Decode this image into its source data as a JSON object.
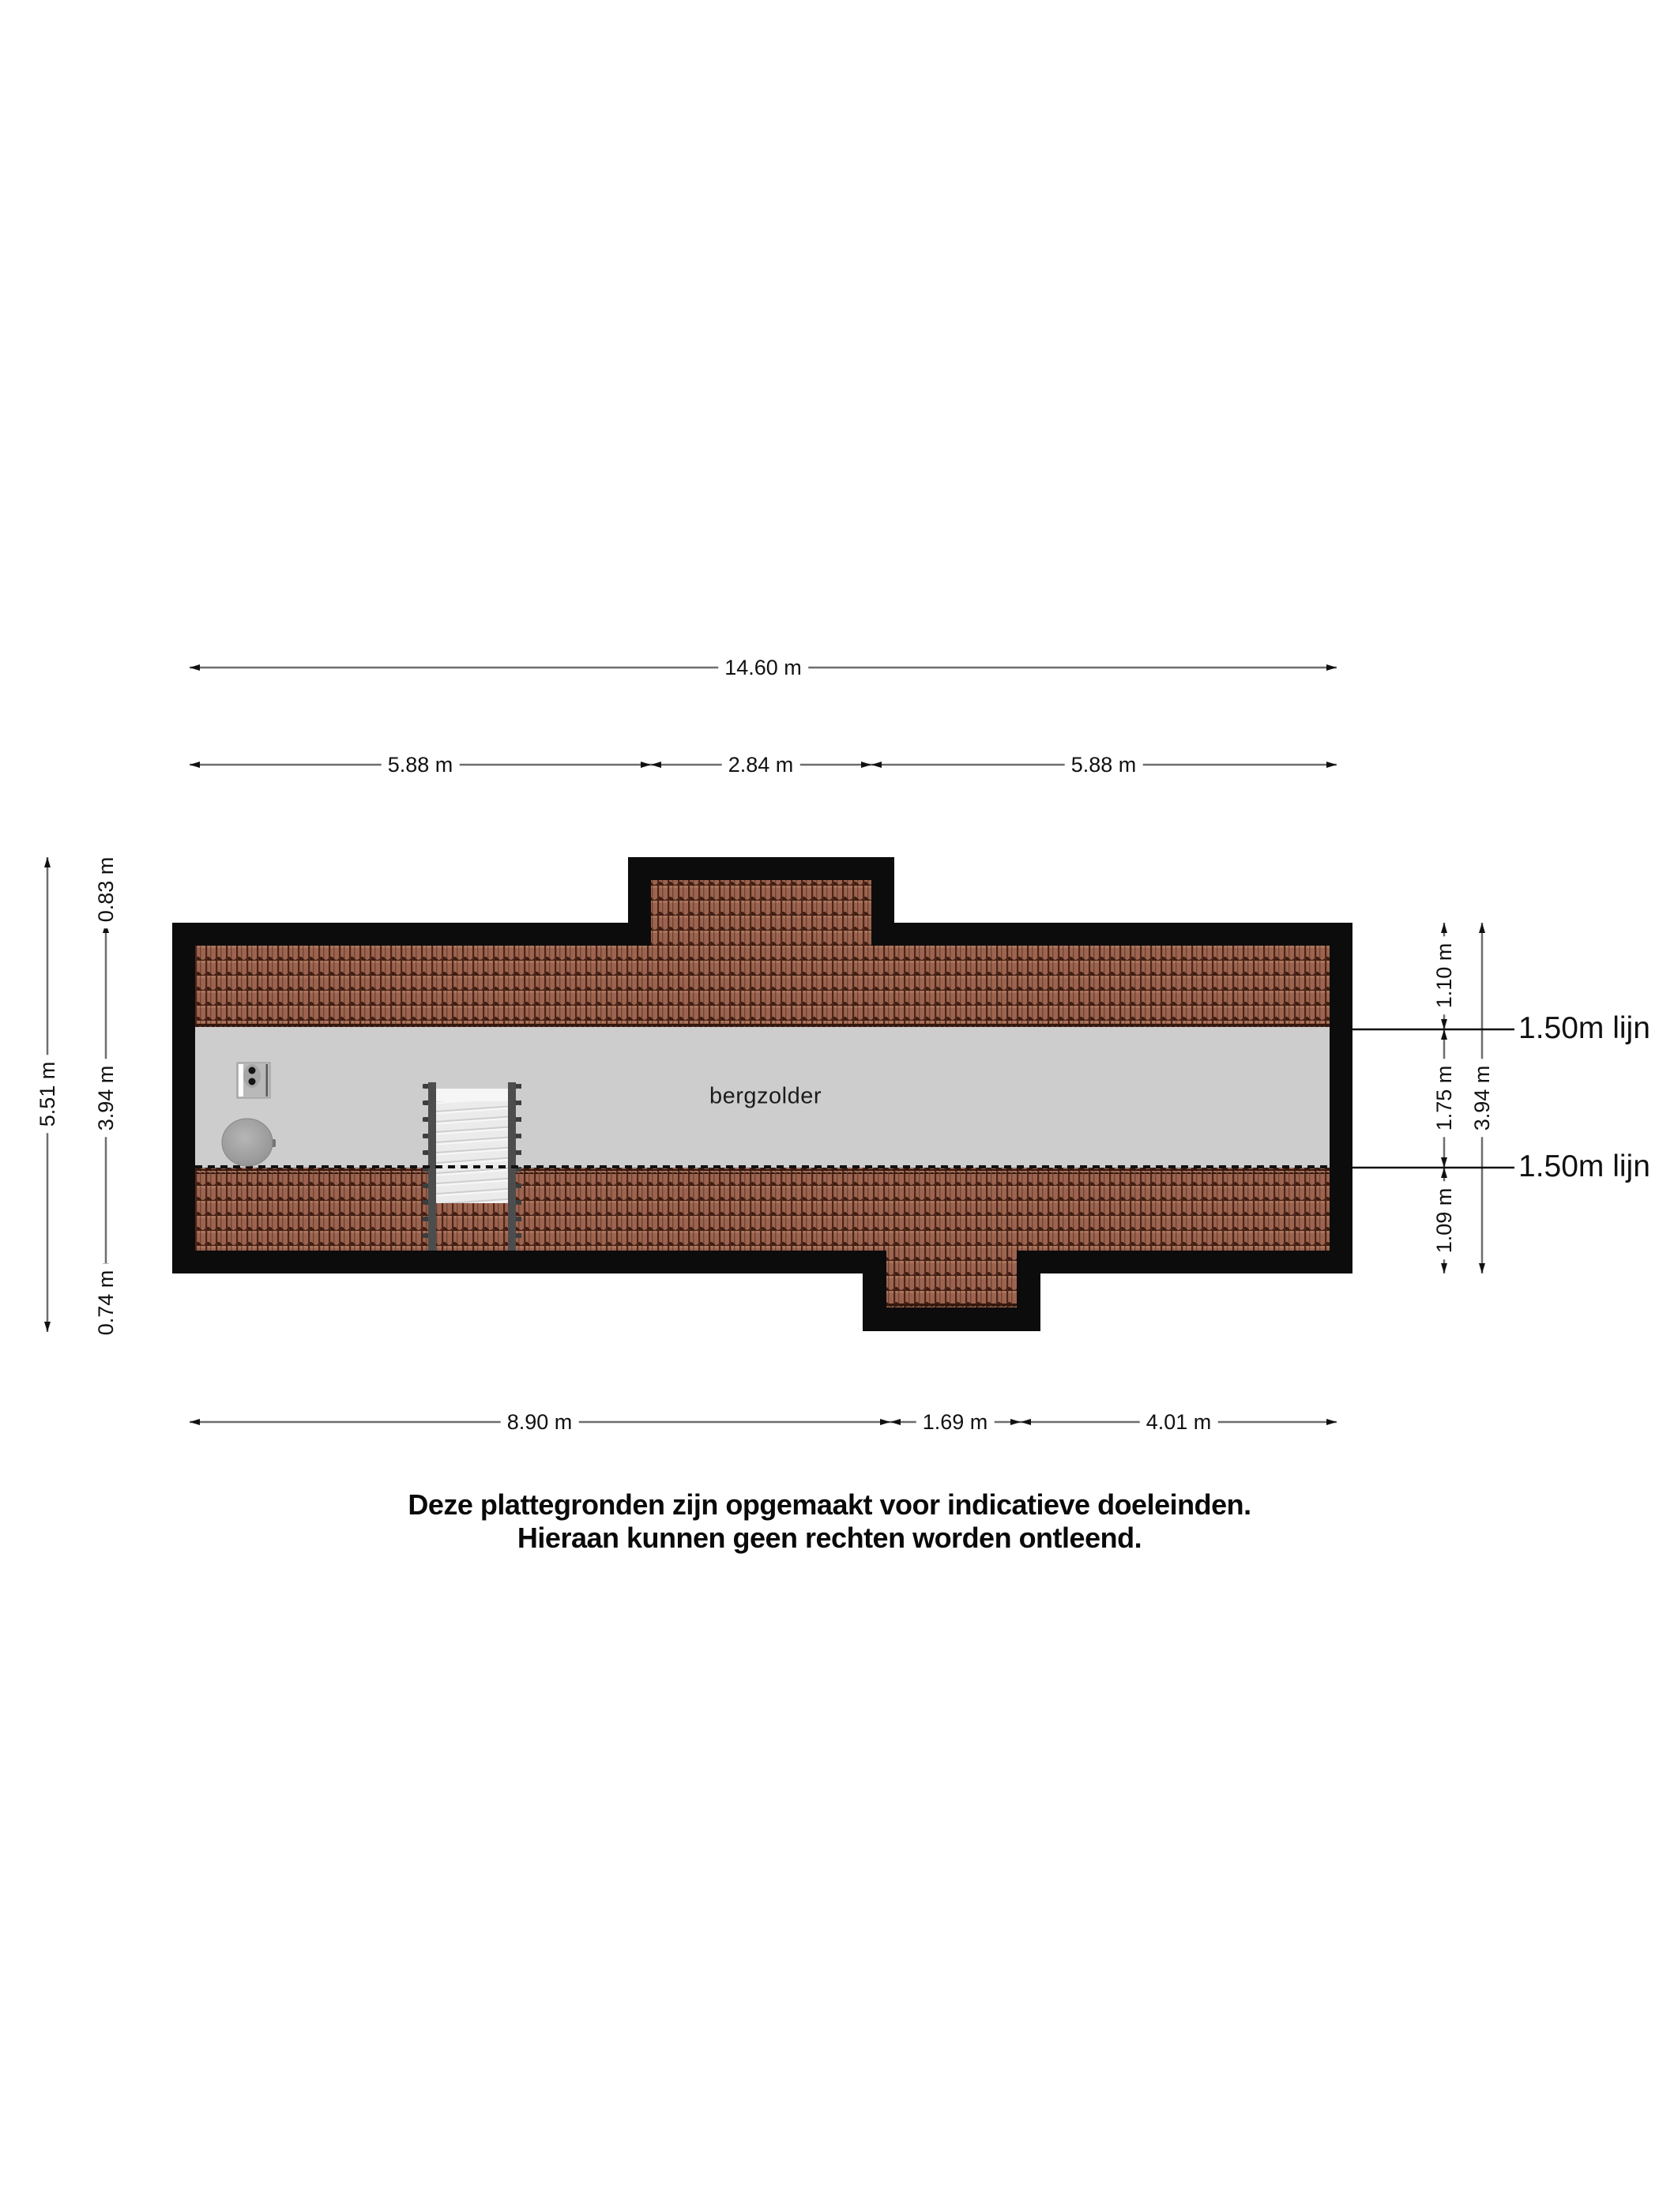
{
  "floor_plan": {
    "room_label": "bergzolder",
    "height_line_labels": [
      "1.50m lijn",
      "1.50m lijn"
    ],
    "dimensions": {
      "top_total": "14.60 m",
      "top_segments": [
        "5.88 m",
        "2.84 m",
        "5.88 m"
      ],
      "bottom_segments": [
        "8.90 m",
        "1.69 m",
        "4.01 m"
      ],
      "left_total": "5.51 m",
      "left_segments": [
        "0.83 m",
        "3.94 m",
        "0.74 m"
      ],
      "right_total": "3.94 m",
      "right_segments": [
        "1.10 m",
        "1.75 m",
        "1.09 m"
      ]
    },
    "colors": {
      "wall": "#0c0c0c",
      "roof_tile": "#9c6450",
      "roof_tile_shadow": "#401d12",
      "floor": "#cdcdcd",
      "stair_rail": "#4d4d4d",
      "dimension_line": "#6e6e6e",
      "text": "#111111"
    }
  },
  "disclaimer": [
    "Deze plattegronden zijn opgemaakt voor indicatieve doeleinden.",
    "Hieraan kunnen geen rechten worden ontleend."
  ]
}
